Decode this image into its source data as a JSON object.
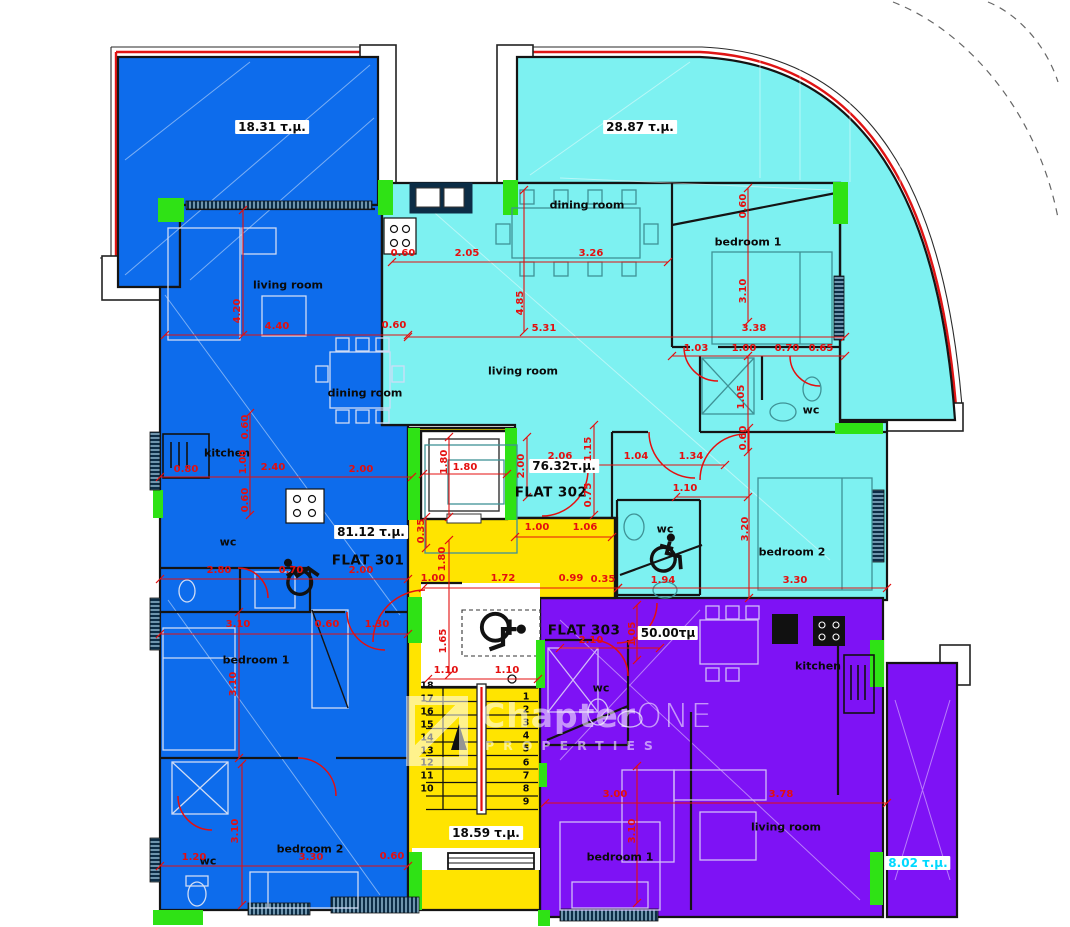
{
  "plan": {
    "flats": [
      {
        "id": "FLAT 301",
        "area": "81.12 τ.μ.",
        "color": "#0d6cec",
        "balcony_area": "18.31 τ.μ.",
        "rooms": [
          "living room",
          "dining room",
          "kitchen",
          "wc",
          "bedroom 1",
          "bedroom 2",
          "wc"
        ]
      },
      {
        "id": "FLAT 302",
        "area": "76.32τ.μ.",
        "color": "#7df1f1",
        "balcony_area": "28.87 τ.μ.",
        "rooms": [
          "dining room",
          "living room",
          "bedroom 1",
          "wc",
          "wc",
          "bedroom 2"
        ]
      },
      {
        "id": "FLAT 303",
        "area": "50.00τμ",
        "color": "#7e12f5",
        "balcony_area": "8.02 τ.μ.",
        "rooms": [
          "wc",
          "kitchen",
          "living room",
          "bedroom 1"
        ]
      }
    ],
    "stairwell_area": "18.59 τ.μ.",
    "accent_colors": {
      "dimension_red": "#e40f0f",
      "column_green": "#2fe215",
      "core_yellow": "#ffe400"
    }
  },
  "labels": {
    "areas": [
      {
        "t": "18.31  τ.μ.",
        "x": 272,
        "y": 127
      },
      {
        "t": "28.87  τ.μ.",
        "x": 640,
        "y": 127
      },
      {
        "t": "81.12  τ.μ.",
        "x": 371,
        "y": 532
      },
      {
        "t": "76.32τ.μ.",
        "x": 564,
        "y": 466
      },
      {
        "t": "50.00τμ",
        "x": 668,
        "y": 633
      },
      {
        "t": "18.59  τ.μ.",
        "x": 486,
        "y": 833
      },
      {
        "t": "8.02  τ.μ.",
        "x": 918,
        "y": 863,
        "c": "#00d9ff"
      }
    ],
    "flats": [
      {
        "t": "FLAT 301",
        "x": 368,
        "y": 561
      },
      {
        "t": "FLAT 302",
        "x": 551,
        "y": 493
      },
      {
        "t": "FLAT 303",
        "x": 584,
        "y": 631
      }
    ],
    "rooms": [
      {
        "t": "living room",
        "x": 288,
        "y": 285
      },
      {
        "t": "dining room",
        "x": 365,
        "y": 393
      },
      {
        "t": "kitchen",
        "x": 227,
        "y": 453
      },
      {
        "t": "wc",
        "x": 228,
        "y": 542
      },
      {
        "t": "bedroom 1",
        "x": 256,
        "y": 660
      },
      {
        "t": "bedroom 2",
        "x": 310,
        "y": 849
      },
      {
        "t": "wc",
        "x": 208,
        "y": 861
      },
      {
        "t": "dining room",
        "x": 587,
        "y": 205
      },
      {
        "t": "bedroom 1",
        "x": 748,
        "y": 242
      },
      {
        "t": "living room",
        "x": 523,
        "y": 371
      },
      {
        "t": "wc",
        "x": 811,
        "y": 410
      },
      {
        "t": "wc",
        "x": 665,
        "y": 529
      },
      {
        "t": "bedroom 2",
        "x": 792,
        "y": 552
      },
      {
        "t": "wc",
        "x": 601,
        "y": 688
      },
      {
        "t": "kitchen",
        "x": 818,
        "y": 666
      },
      {
        "t": "living room",
        "x": 786,
        "y": 827
      },
      {
        "t": "bedroom 1",
        "x": 620,
        "y": 857
      }
    ],
    "dims": [
      {
        "t": "4.40",
        "x": 277,
        "y": 327
      },
      {
        "t": "0.60",
        "x": 394,
        "y": 326
      },
      {
        "t": "0.60",
        "x": 403,
        "y": 254
      },
      {
        "t": "2.05",
        "x": 467,
        "y": 254
      },
      {
        "t": "3.26",
        "x": 591,
        "y": 254
      },
      {
        "t": "5.31",
        "x": 544,
        "y": 329
      },
      {
        "t": "3.38",
        "x": 754,
        "y": 329
      },
      {
        "t": "1.03",
        "x": 696,
        "y": 349
      },
      {
        "t": "1.00",
        "x": 744,
        "y": 349
      },
      {
        "t": "0.70",
        "x": 787,
        "y": 349
      },
      {
        "t": "0.65",
        "x": 821,
        "y": 349
      },
      {
        "t": "2.06",
        "x": 560,
        "y": 457
      },
      {
        "t": "1.04",
        "x": 636,
        "y": 457
      },
      {
        "t": "1.34",
        "x": 691,
        "y": 457
      },
      {
        "t": "0.80",
        "x": 186,
        "y": 470
      },
      {
        "t": "2.40",
        "x": 273,
        "y": 468
      },
      {
        "t": "2.00",
        "x": 361,
        "y": 470
      },
      {
        "t": "1.80",
        "x": 465,
        "y": 468
      },
      {
        "t": "2.80",
        "x": 219,
        "y": 571
      },
      {
        "t": "0.70",
        "x": 291,
        "y": 571
      },
      {
        "t": "2.00",
        "x": 361,
        "y": 571
      },
      {
        "t": "1.00",
        "x": 537,
        "y": 528
      },
      {
        "t": "1.06",
        "x": 585,
        "y": 528
      },
      {
        "t": "1.00",
        "x": 433,
        "y": 579
      },
      {
        "t": "1.72",
        "x": 503,
        "y": 579
      },
      {
        "t": "0.99",
        "x": 571,
        "y": 579
      },
      {
        "t": "0.35",
        "x": 603,
        "y": 580
      },
      {
        "t": "3.10",
        "x": 238,
        "y": 625
      },
      {
        "t": "0.60",
        "x": 327,
        "y": 625
      },
      {
        "t": "1.30",
        "x": 377,
        "y": 625
      },
      {
        "t": "2.10",
        "x": 591,
        "y": 641
      },
      {
        "t": "1.10",
        "x": 446,
        "y": 671
      },
      {
        "t": "1.10",
        "x": 507,
        "y": 671
      },
      {
        "t": "1.94",
        "x": 663,
        "y": 581
      },
      {
        "t": "3.30",
        "x": 795,
        "y": 581
      },
      {
        "t": "1.10",
        "x": 685,
        "y": 489
      },
      {
        "t": "3.00",
        "x": 615,
        "y": 795
      },
      {
        "t": "3.78",
        "x": 781,
        "y": 795
      },
      {
        "t": "1.20",
        "x": 194,
        "y": 858
      },
      {
        "t": "3.30",
        "x": 311,
        "y": 858
      },
      {
        "t": "0.60",
        "x": 392,
        "y": 857
      },
      {
        "t": "4.20",
        "x": 238,
        "y": 311,
        "v": 1
      },
      {
        "t": "4.85",
        "x": 521,
        "y": 303,
        "v": 1
      },
      {
        "t": "0.60",
        "x": 744,
        "y": 206,
        "v": 1
      },
      {
        "t": "3.10",
        "x": 744,
        "y": 291,
        "v": 1
      },
      {
        "t": "1.05",
        "x": 742,
        "y": 397,
        "v": 1
      },
      {
        "t": "0.60",
        "x": 744,
        "y": 438,
        "v": 1
      },
      {
        "t": "1.15",
        "x": 589,
        "y": 449,
        "v": 1
      },
      {
        "t": "0.75",
        "x": 589,
        "y": 495,
        "v": 1
      },
      {
        "t": "2.00",
        "x": 522,
        "y": 466,
        "v": 1
      },
      {
        "t": "1.80",
        "x": 445,
        "y": 462,
        "v": 1
      },
      {
        "t": "0.35",
        "x": 422,
        "y": 531,
        "v": 1
      },
      {
        "t": "1.80",
        "x": 443,
        "y": 559,
        "v": 1
      },
      {
        "t": "1.65",
        "x": 444,
        "y": 641,
        "v": 1
      },
      {
        "t": "0.60",
        "x": 246,
        "y": 427,
        "v": 1
      },
      {
        "t": "1.00",
        "x": 244,
        "y": 462,
        "v": 1
      },
      {
        "t": "0.60",
        "x": 246,
        "y": 500,
        "v": 1
      },
      {
        "t": "3.10",
        "x": 234,
        "y": 684,
        "v": 1
      },
      {
        "t": "3.10",
        "x": 236,
        "y": 831,
        "v": 1
      },
      {
        "t": "3.20",
        "x": 746,
        "y": 529,
        "v": 1
      },
      {
        "t": "3.10",
        "x": 633,
        "y": 831,
        "v": 1
      },
      {
        "t": "1.05",
        "x": 633,
        "y": 634,
        "v": 1
      }
    ]
  },
  "stairs": {
    "right_numbers": [
      "1",
      "2",
      "3",
      "4",
      "5",
      "6",
      "7",
      "8",
      "9"
    ],
    "left_numbers": [
      "18",
      "17",
      "16",
      "15",
      "14",
      "13",
      "12",
      "11",
      "10"
    ]
  },
  "watermark": {
    "brand_bold": "Chapter",
    "brand_light": "ONE",
    "subtitle": "PROPERTIES"
  }
}
